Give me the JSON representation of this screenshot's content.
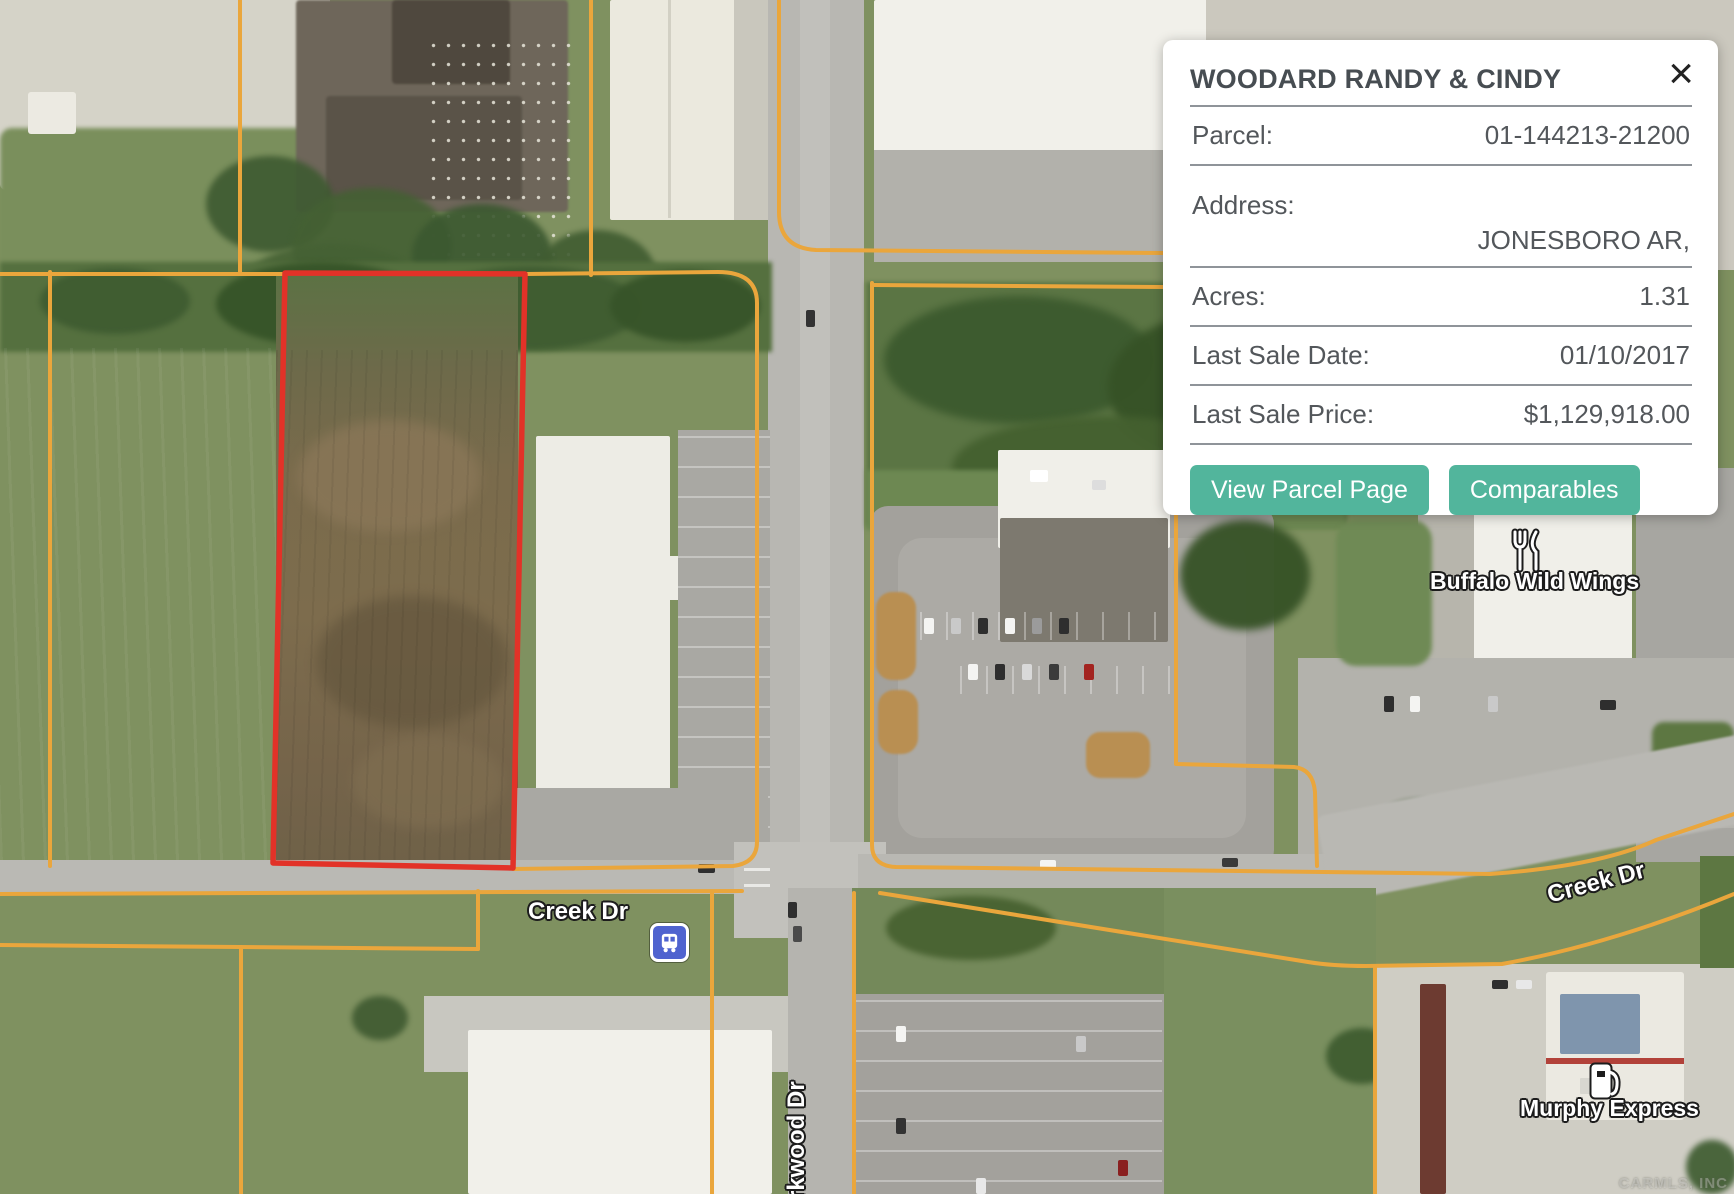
{
  "popup": {
    "title": "WOODARD RANDY & CINDY",
    "close_label": "×",
    "rows": {
      "parcel": {
        "label": "Parcel:",
        "value": "01-144213-21200"
      },
      "address": {
        "label": "Address:",
        "value": "JONESBORO AR,"
      },
      "acres": {
        "label": "Acres:",
        "value": "1.31"
      },
      "last_sale_date": {
        "label": "Last Sale Date:",
        "value": "01/10/2017"
      },
      "last_sale_price": {
        "label": "Last Sale Price:",
        "value": "$1,129,918.00"
      }
    },
    "buttons": {
      "view_parcel": "View Parcel Page",
      "comparables": "Comparables"
    }
  },
  "map": {
    "street_labels": {
      "creek_dr_west": "Creek Dr",
      "creek_dr_east": "Creek Dr",
      "parkwood_dr": "rkwood Dr"
    },
    "poi_labels": {
      "buffalo_wild_wings": "Buffalo Wild Wings",
      "murphy_express": "Murphy Express"
    },
    "icons": [
      "bus-stop-icon",
      "restaurant-icon",
      "gas-station-icon"
    ],
    "watermark": "CARMLS, INC"
  },
  "colors": {
    "accent_teal": "#52b59c",
    "parcel_line_orange": "#eaa63c",
    "selected_parcel_red": "#e23228",
    "popup_text": "#53575b"
  }
}
